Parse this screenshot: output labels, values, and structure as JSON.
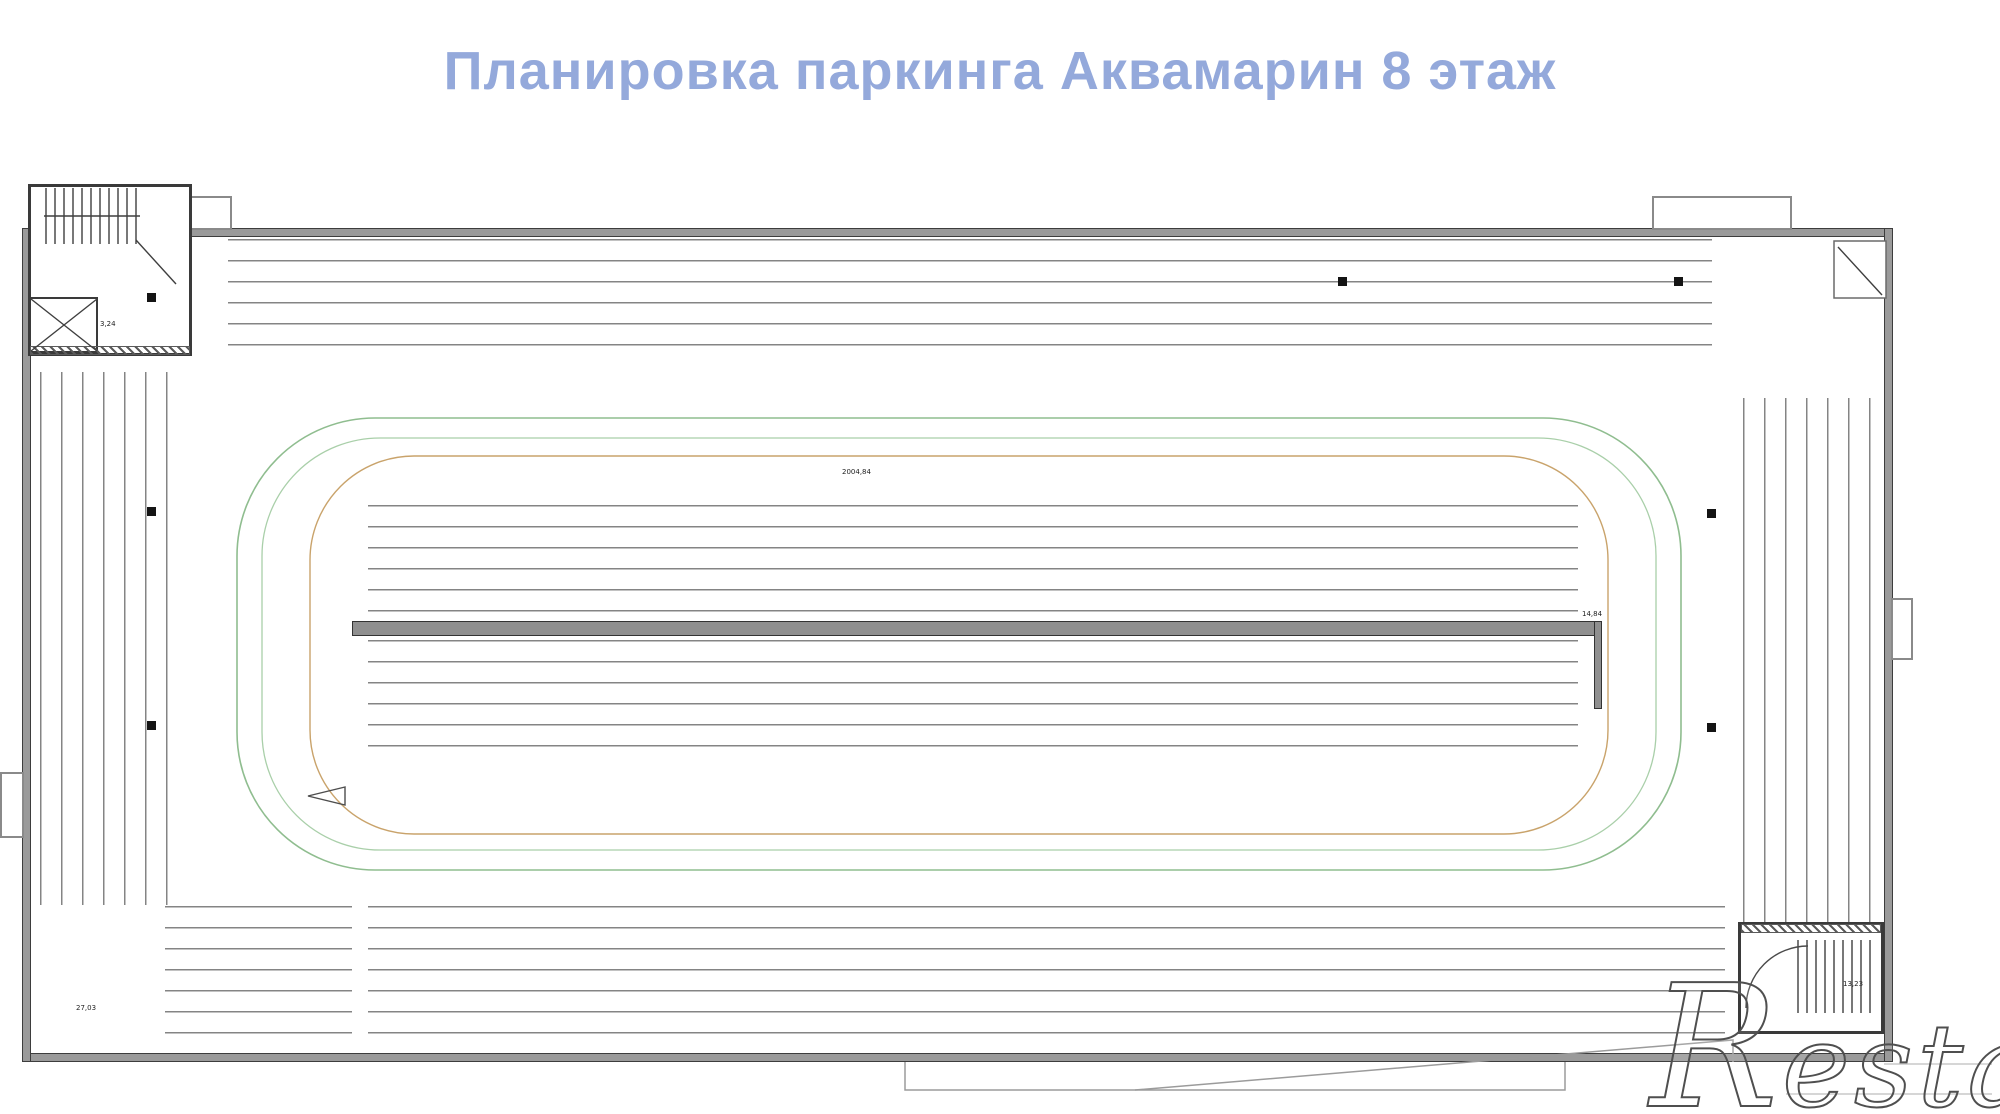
{
  "title": "Планировка паркинга Аквамарин 8 этаж",
  "watermark": {
    "initial": "R",
    "rest": "estate"
  },
  "colors": {
    "title_blue": "#94a9db",
    "wall_gray": "#9a9a9a",
    "shaded_space": "#c8c8c8",
    "loop_green": "#8fbd8f",
    "loop_green_light": "#a9cfa9",
    "loop_tan": "#c9a36b",
    "watermark_stroke": "#4f4f4f"
  },
  "plan": {
    "rows": [
      {
        "name": "top-row",
        "dir": "v",
        "x": 228,
        "y": 239,
        "spaceW": 64,
        "spaceH": 126,
        "plateTop": 0.36,
        "dim": "13,25",
        "dimPos": "top",
        "gapAfter": [
          1
        ],
        "gapSize": 12,
        "numbers": [
          "678",
          "679",
          "680",
          "681",
          "682",
          "683",
          "684",
          "685",
          "686",
          "687",
          "688",
          "689",
          "690",
          "691",
          "692",
          "693",
          "694",
          "695",
          "696",
          "697",
          "698",
          "699",
          "700"
        ]
      },
      {
        "name": "island-upper-row",
        "dir": "v",
        "x": 368,
        "y": 505,
        "spaceW": 59.7,
        "spaceH": 117,
        "plateTop": 0.56,
        "dim": "13,25",
        "dimPos": "bottom",
        "gapAfter": [
          9
        ],
        "gapSize": 16,
        "numbers": [
          "734",
          "735",
          "736",
          "737",
          "738",
          "739",
          "740",
          "741",
          "742",
          "743",
          "744",
          "745",
          "746",
          "747",
          "748",
          "749",
          "750",
          "751",
          "752",
          "753"
        ]
      },
      {
        "name": "island-lower-row",
        "dir": "v",
        "x": 368,
        "y": 640,
        "spaceW": 59.7,
        "spaceH": 121,
        "plateTop": 0.42,
        "dim": "13,25",
        "dimPos": "top",
        "gapAfter": [
          9
        ],
        "gapSize": 16,
        "numbers": [
          "773",
          "772",
          "771",
          "770",
          "769",
          "768",
          "767",
          "766",
          "765",
          "764",
          "763",
          "762",
          "761",
          "760",
          "759",
          "758",
          "757",
          "756",
          "755",
          "754"
        ]
      },
      {
        "name": "bottom-left-group",
        "dir": "v",
        "x": 165,
        "y": 906,
        "spaceW": 62.3,
        "spaceH": 128,
        "plateTop": 0.56,
        "dim": "13,25",
        "dimPos": "bottom",
        "numbers": [
          "733",
          "732",
          "731"
        ]
      },
      {
        "name": "bottom-row",
        "dir": "v",
        "x": 368,
        "y": 906,
        "spaceW": 61.7,
        "spaceH": 128,
        "plateTop": 0.56,
        "dim": "13,25",
        "dimPos": "bottom",
        "numbers": [
          "730",
          "729",
          "728",
          "727",
          "726",
          "725",
          "724",
          "723",
          "722",
          "721",
          "720",
          "719",
          "718",
          "717",
          "716",
          "715",
          "714",
          "713",
          "712",
          "711",
          "710",
          "709"
        ]
      },
      {
        "name": "left-column",
        "dir": "h-right",
        "x": 40,
        "y": 372,
        "spaceW": 138,
        "spaceH": 66.6,
        "dimPos": "right",
        "shadedIndex": 6,
        "dims": [
          "18,74",
          "15,74",
          "13,47",
          "13,47",
          "13,47",
          "13,47",
          "16,74",
          "18,74"
        ],
        "numbers": [
          "677",
          "676",
          "675",
          "674",
          "673",
          "672",
          "671",
          "670"
        ]
      },
      {
        "name": "right-column",
        "dir": "h-left",
        "x": 1743,
        "y": 398,
        "spaceW": 137,
        "spaceH": 65.5,
        "dimPos": "left",
        "dims": [
          "13,47",
          "13,47",
          "13,47",
          "15,47",
          "15,47",
          "15,47",
          "17,28",
          "17,30"
        ],
        "numbers": [
          "708",
          "707",
          "706",
          "705",
          "704",
          "703",
          "702",
          "701"
        ]
      }
    ],
    "labels": [
      {
        "text": "3,24",
        "x": 100,
        "y": 320
      },
      {
        "text": "2004,84",
        "x": 842,
        "y": 468
      },
      {
        "text": "14,84",
        "x": 1582,
        "y": 610
      },
      {
        "text": "27,03",
        "x": 76,
        "y": 1004
      },
      {
        "text": "13,23",
        "x": 1843,
        "y": 980
      }
    ]
  }
}
